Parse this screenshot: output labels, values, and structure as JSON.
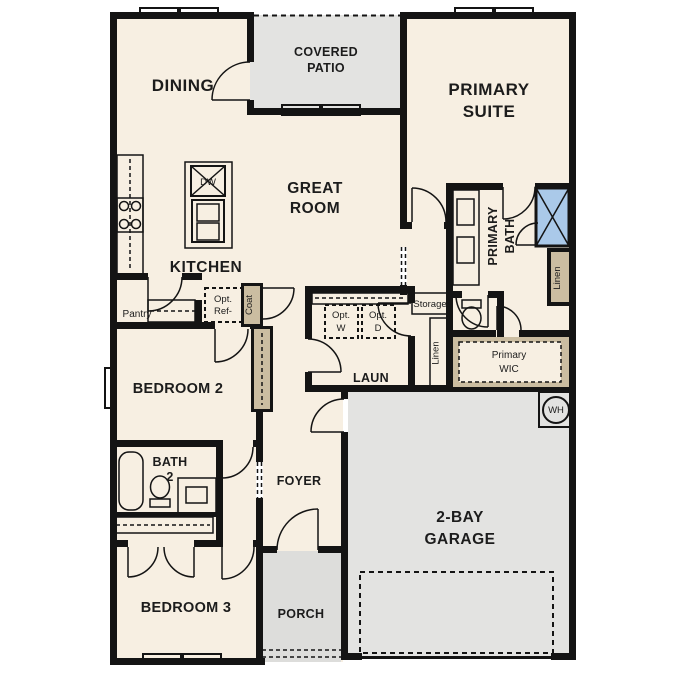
{
  "plan_title": "Single-story residential floor plan",
  "labels": {
    "dining": [
      "DINING"
    ],
    "covered_patio": [
      "COVERED",
      "PATIO"
    ],
    "primary_suite": [
      "PRIMARY",
      "SUITE"
    ],
    "great_room": [
      "GREAT",
      "ROOM"
    ],
    "kitchen": [
      "KITCHEN"
    ],
    "pantry": [
      "Pantry"
    ],
    "dishwasher": [
      "DW"
    ],
    "opt_ref": [
      "Opt.",
      "Ref-"
    ],
    "coat": [
      "Coat"
    ],
    "primary_bath": [
      "PRIMARY",
      "BATH"
    ],
    "linen_bath": [
      "Linen"
    ],
    "linen_hall": [
      "Linen"
    ],
    "storage": [
      "Storage"
    ],
    "opt_washer": [
      "Opt.",
      "W"
    ],
    "opt_dryer": [
      "Opt.",
      "D"
    ],
    "laundry": [
      "LAUN"
    ],
    "primary_wic": [
      "Primary",
      "WIC"
    ],
    "water_heater": [
      "WH"
    ],
    "bedroom2": [
      "BEDROOM 2"
    ],
    "bath2": [
      "BATH",
      "2"
    ],
    "foyer": [
      "FOYER"
    ],
    "bedroom3": [
      "BEDROOM 3"
    ],
    "porch": [
      "PORCH"
    ],
    "garage": [
      "2-BAY",
      "GARAGE"
    ]
  },
  "fixtures": [
    "kitchen-island-double-sink",
    "dishwasher",
    "range-4-burner",
    "optional-refrigerator",
    "primary-double-vanity",
    "walk-in-shower",
    "toilet-primary",
    "toilet-bath2",
    "bathtub",
    "bath2-vanity-sink",
    "optional-washer",
    "optional-dryer",
    "water-heater"
  ],
  "colors": {
    "wall": "#141414",
    "interior_floor": "#f7efe2",
    "exterior_floor": "#e3e3e1",
    "cabinet_tan": "#cbbda1",
    "fixture_blue": "#aac9e9",
    "optional_gray": "#dcdcdc",
    "background": "#ffffff"
  }
}
